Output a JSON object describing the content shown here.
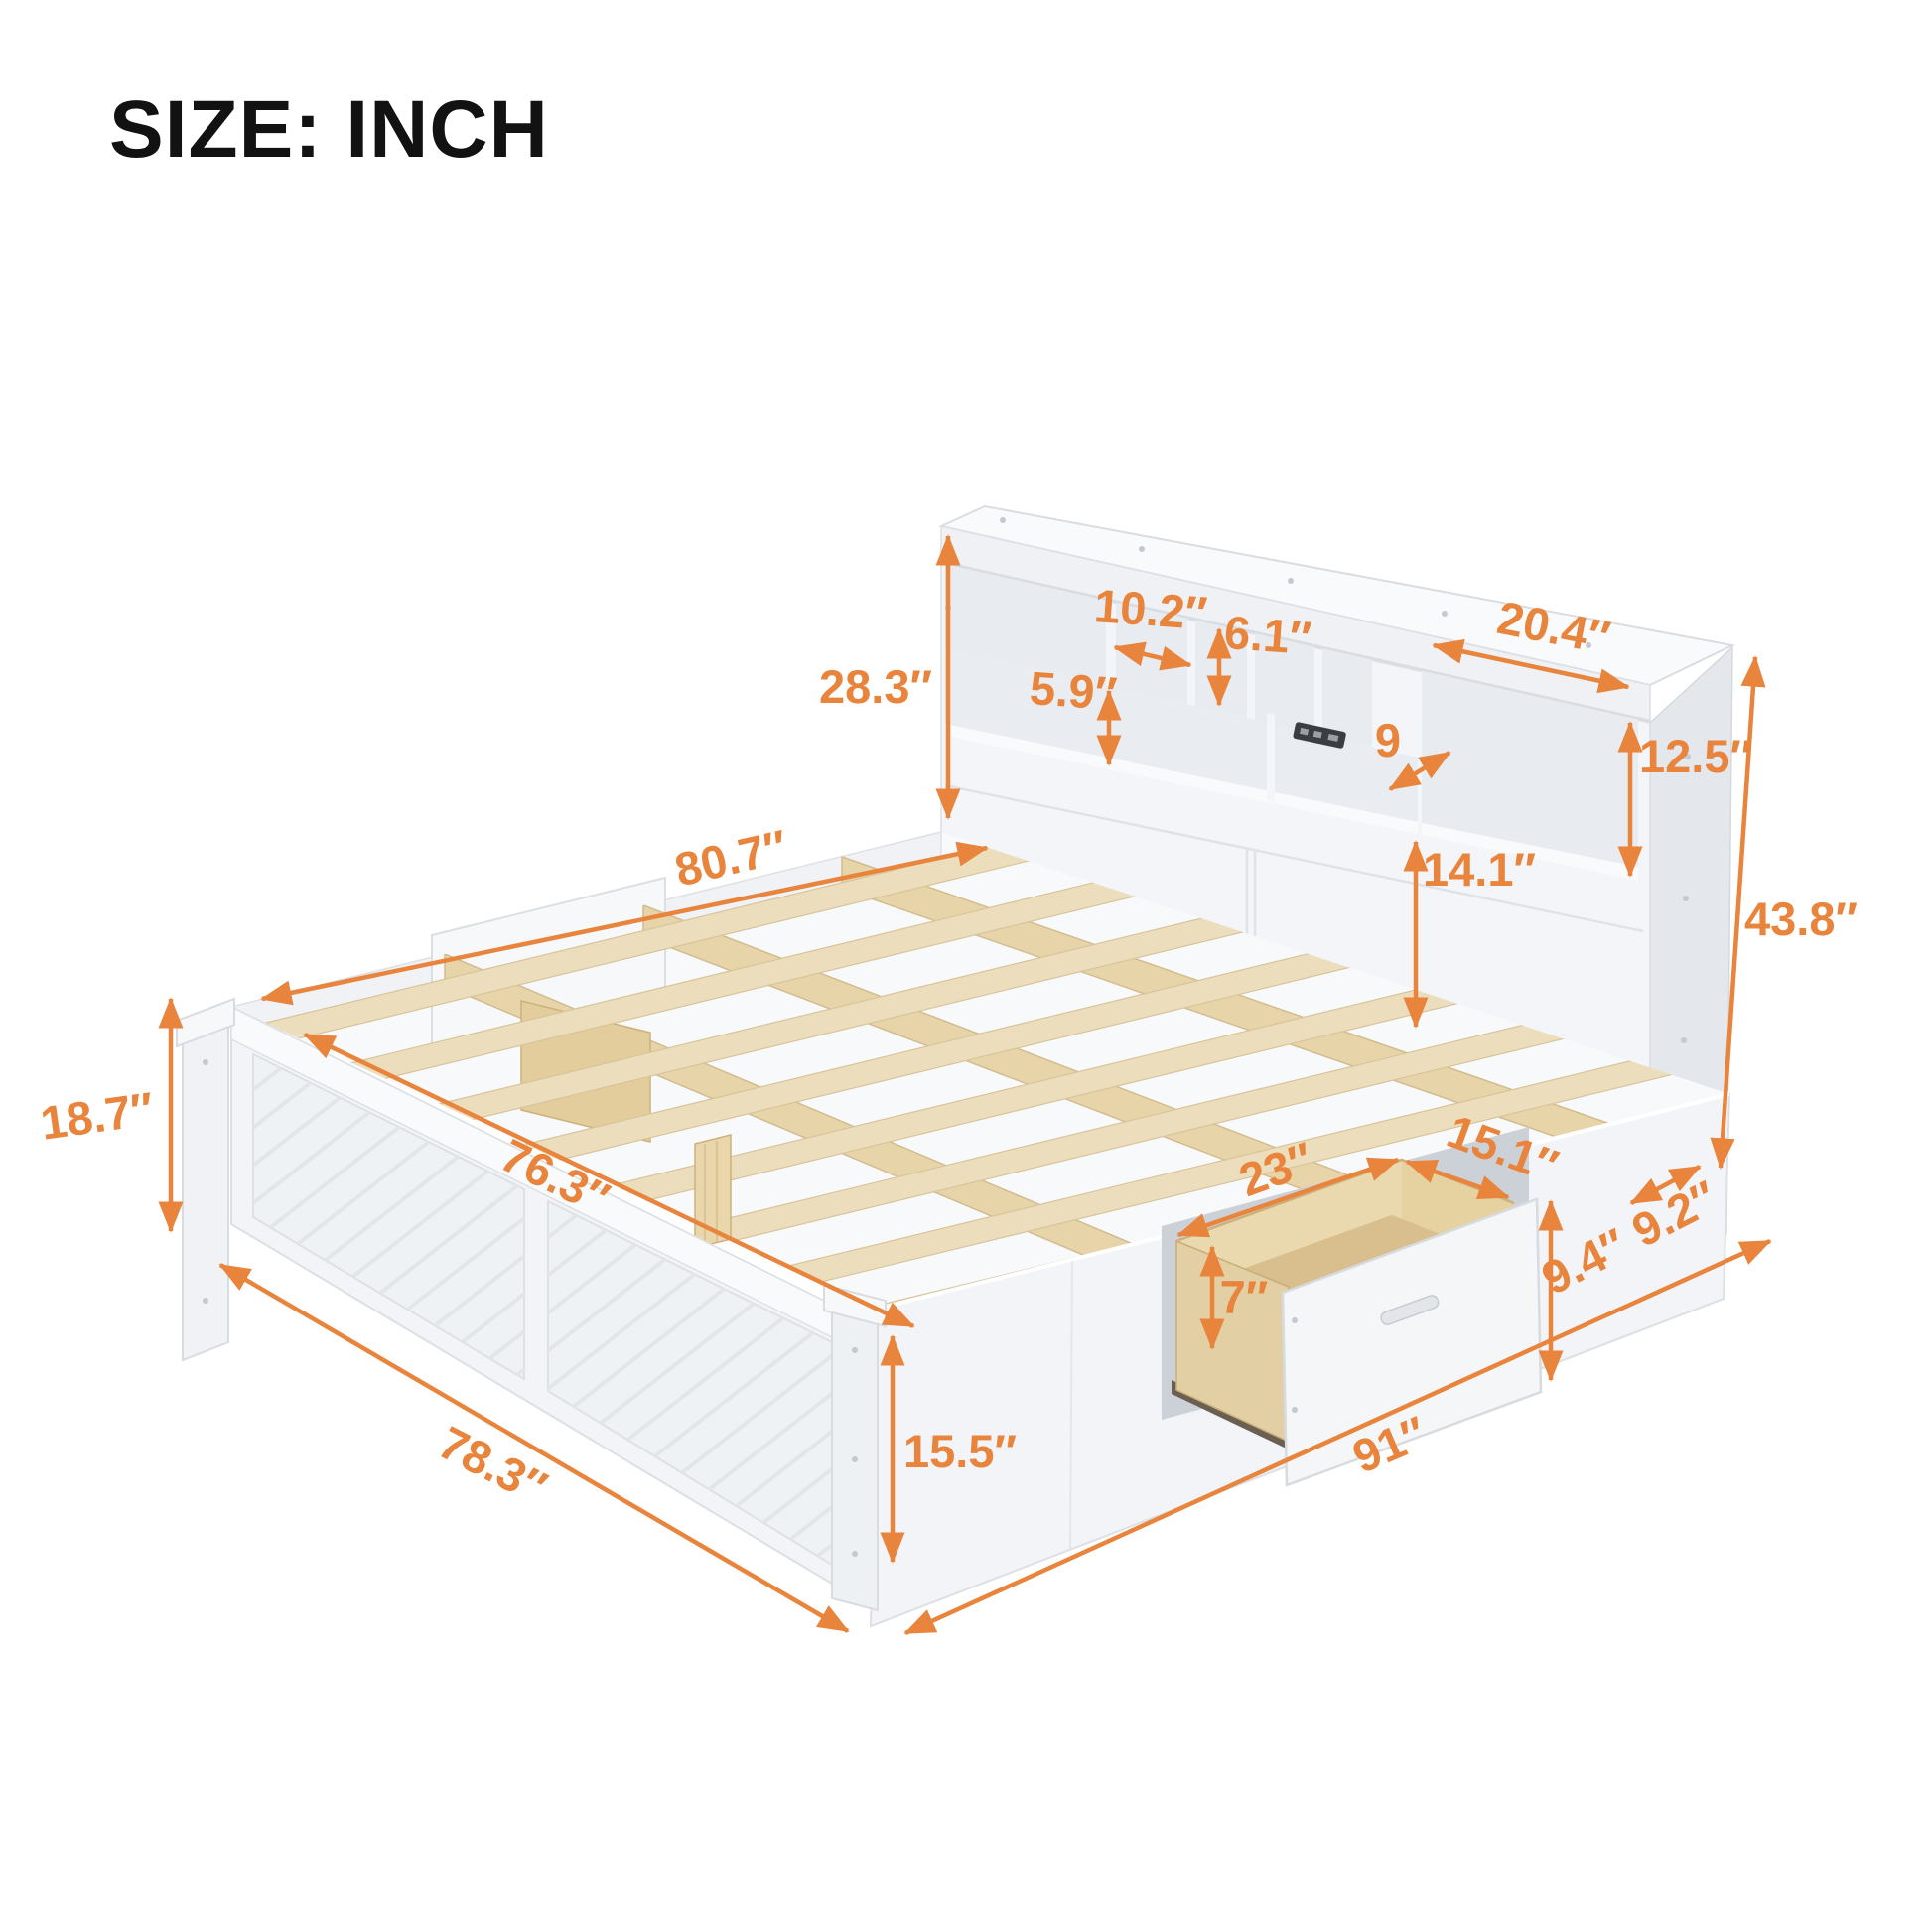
{
  "title": "SIZE: INCH",
  "accent_color": "#E8843C",
  "text_color": "#121212",
  "furniture_colors": {
    "white_body": "#f3f5f7",
    "side_shadow": "#e4e7eb",
    "slat_wood": "#ecdebc",
    "plywood": "#e2cfa4",
    "outlet": "#3a3d42"
  },
  "dimensions": {
    "headboard_upper_height": "28.3″",
    "cubby_small_width": "10.2″",
    "cubby_center_height": "6.1″",
    "right_cubby_width": "20.4″",
    "shelf_height": "5.9″",
    "cubby_depth": "9",
    "right_cubby_height": "12.5″",
    "lower_panel_height": "14.1″",
    "platform_length": "80.7″",
    "headboard_total_height": "43.8″",
    "footboard_height": "18.7″",
    "inner_width": "76.3″",
    "drawer_width": "23″",
    "drawer_depth": "15.1″",
    "drawer_inner_height": "7″",
    "drawer_front_height": "9.4″",
    "headboard_depth": "9.2″",
    "side_rail_height": "15.5″",
    "footboard_width": "78.3″",
    "total_length": "91″"
  }
}
